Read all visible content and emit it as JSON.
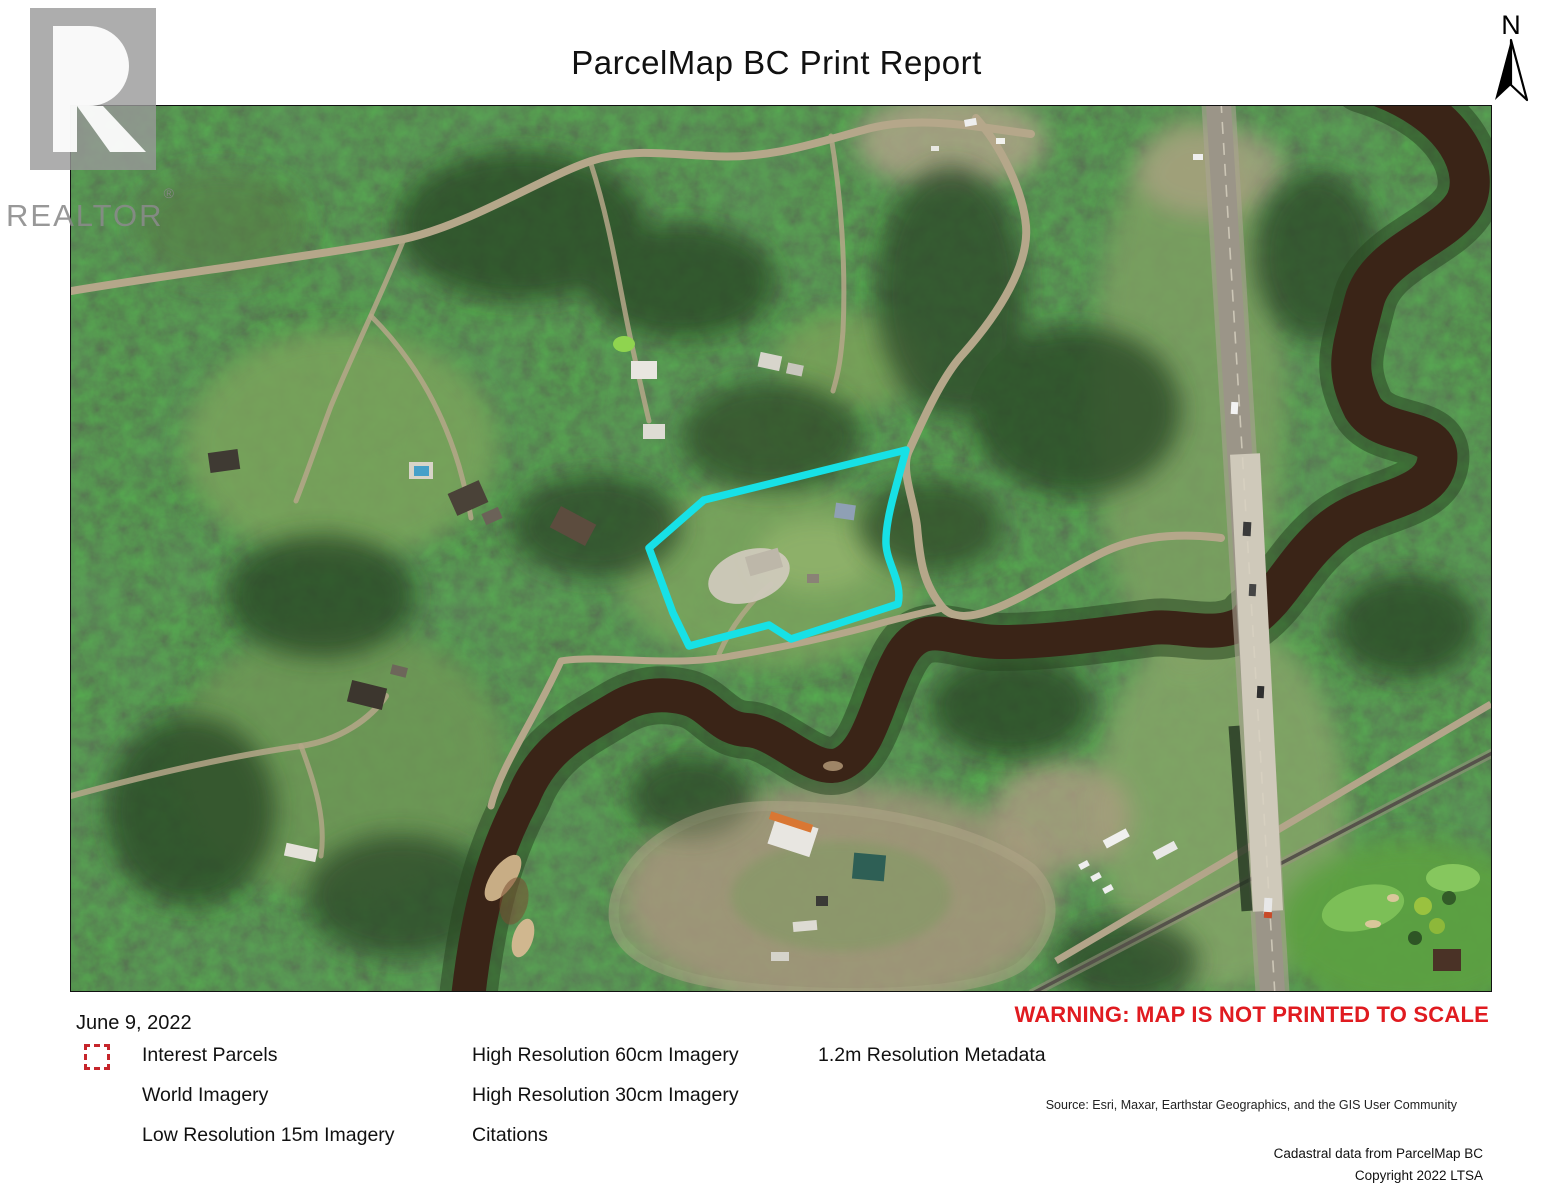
{
  "header": {
    "title": "ParcelMap BC Print Report",
    "north_label": "N"
  },
  "watermark": {
    "brand": "REALTOR",
    "registered_mark": "®"
  },
  "map": {
    "parcel_outline_color": "#17e1e6",
    "river_color": "#3a2417",
    "road_color": "#b5a78a",
    "forest_color": "#45633b"
  },
  "footer": {
    "date": "June 9, 2022",
    "warning": "WARNING: MAP IS NOT PRINTED TO SCALE",
    "legend": {
      "interest_parcels": "Interest Parcels",
      "world_imagery": "World Imagery",
      "low_res": "Low Resolution 15m Imagery",
      "high_res_60": "High Resolution 60cm Imagery",
      "high_res_30": "High Resolution 30cm Imagery",
      "citations": "Citations",
      "metadata_12": "1.2m Resolution Metadata",
      "dash_icon_color": "#c6252b"
    },
    "source": "Source: Esri, Maxar, Earthstar Geographics, and the GIS User Community",
    "cadastral": "Cadastral data from ParcelMap BC",
    "copyright": "Copyright 2022 LTSA"
  }
}
